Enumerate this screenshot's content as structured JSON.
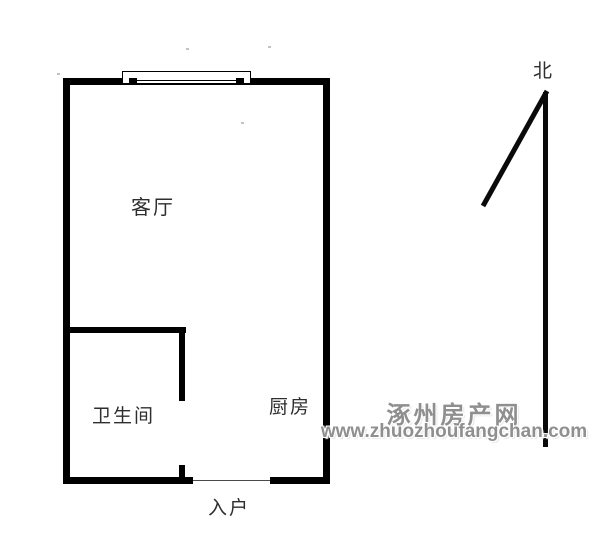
{
  "image": {
    "kind": "apartment floor plan",
    "width": 604,
    "height": 538,
    "background": "#ffffff"
  },
  "floorplan": {
    "labels": {
      "living_room": "客厅",
      "bathroom": "卫生间",
      "kitchen": "厨房",
      "entrance": "入户",
      "north": "北"
    },
    "colors": {
      "wall": "#000000",
      "label_text": "#2e2e2e"
    }
  },
  "watermark": {
    "site_name": "涿州房产网",
    "site_url": "www.zhuozhoufangchan.com",
    "color": "#8f8f8f"
  }
}
